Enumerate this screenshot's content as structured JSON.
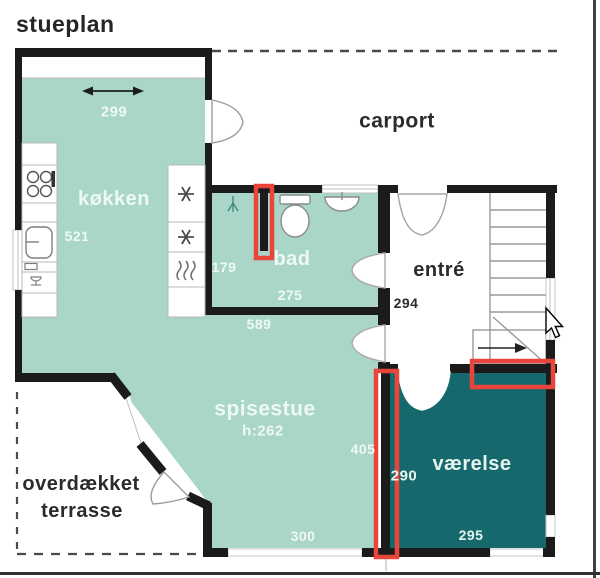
{
  "title": "stueplan",
  "plan": {
    "rooms": {
      "kitchen": {
        "name": "køkken",
        "dim_width": "299",
        "dim_depth": "521"
      },
      "bathroom": {
        "name": "bad",
        "dim_left": "179",
        "dim_bottom": "275"
      },
      "carport": {
        "name": "carport"
      },
      "entry": {
        "name": "entré",
        "dim_width": "294"
      },
      "dining": {
        "name": "spisestue",
        "ceiling_height": "h:262",
        "dim_top": "589",
        "dim_right": "405",
        "dim_bottom": "300"
      },
      "terrace": {
        "name_line1": "overdækket",
        "name_line2": "terrasse"
      },
      "bedroom": {
        "name": "værelse",
        "dim_left": "290",
        "dim_bottom": "295"
      }
    }
  },
  "icons": {
    "appliance_column": [
      "snowflake-icon",
      "snowflake-icon",
      "heat-waves-icon"
    ],
    "kitchen_counter": [
      "cooktop-icon",
      "sink-icon",
      "dishwasher-icon"
    ],
    "bathroom_fixtures": [
      "shower-icon",
      "toilet-icon",
      "washbasin-icon"
    ],
    "other": [
      "stairs-arrow-icon",
      "dimension-arrow-icon",
      "mouse-cursor"
    ]
  },
  "colors": {
    "room_light": "#a9d6c8",
    "room_dark": "#15696c",
    "wall": "#1b1b1b",
    "highlight_red": "#e8463c",
    "dashed_line": "#4a4a4a",
    "title_text": "#262626",
    "label_light": "#f3fbf7"
  }
}
